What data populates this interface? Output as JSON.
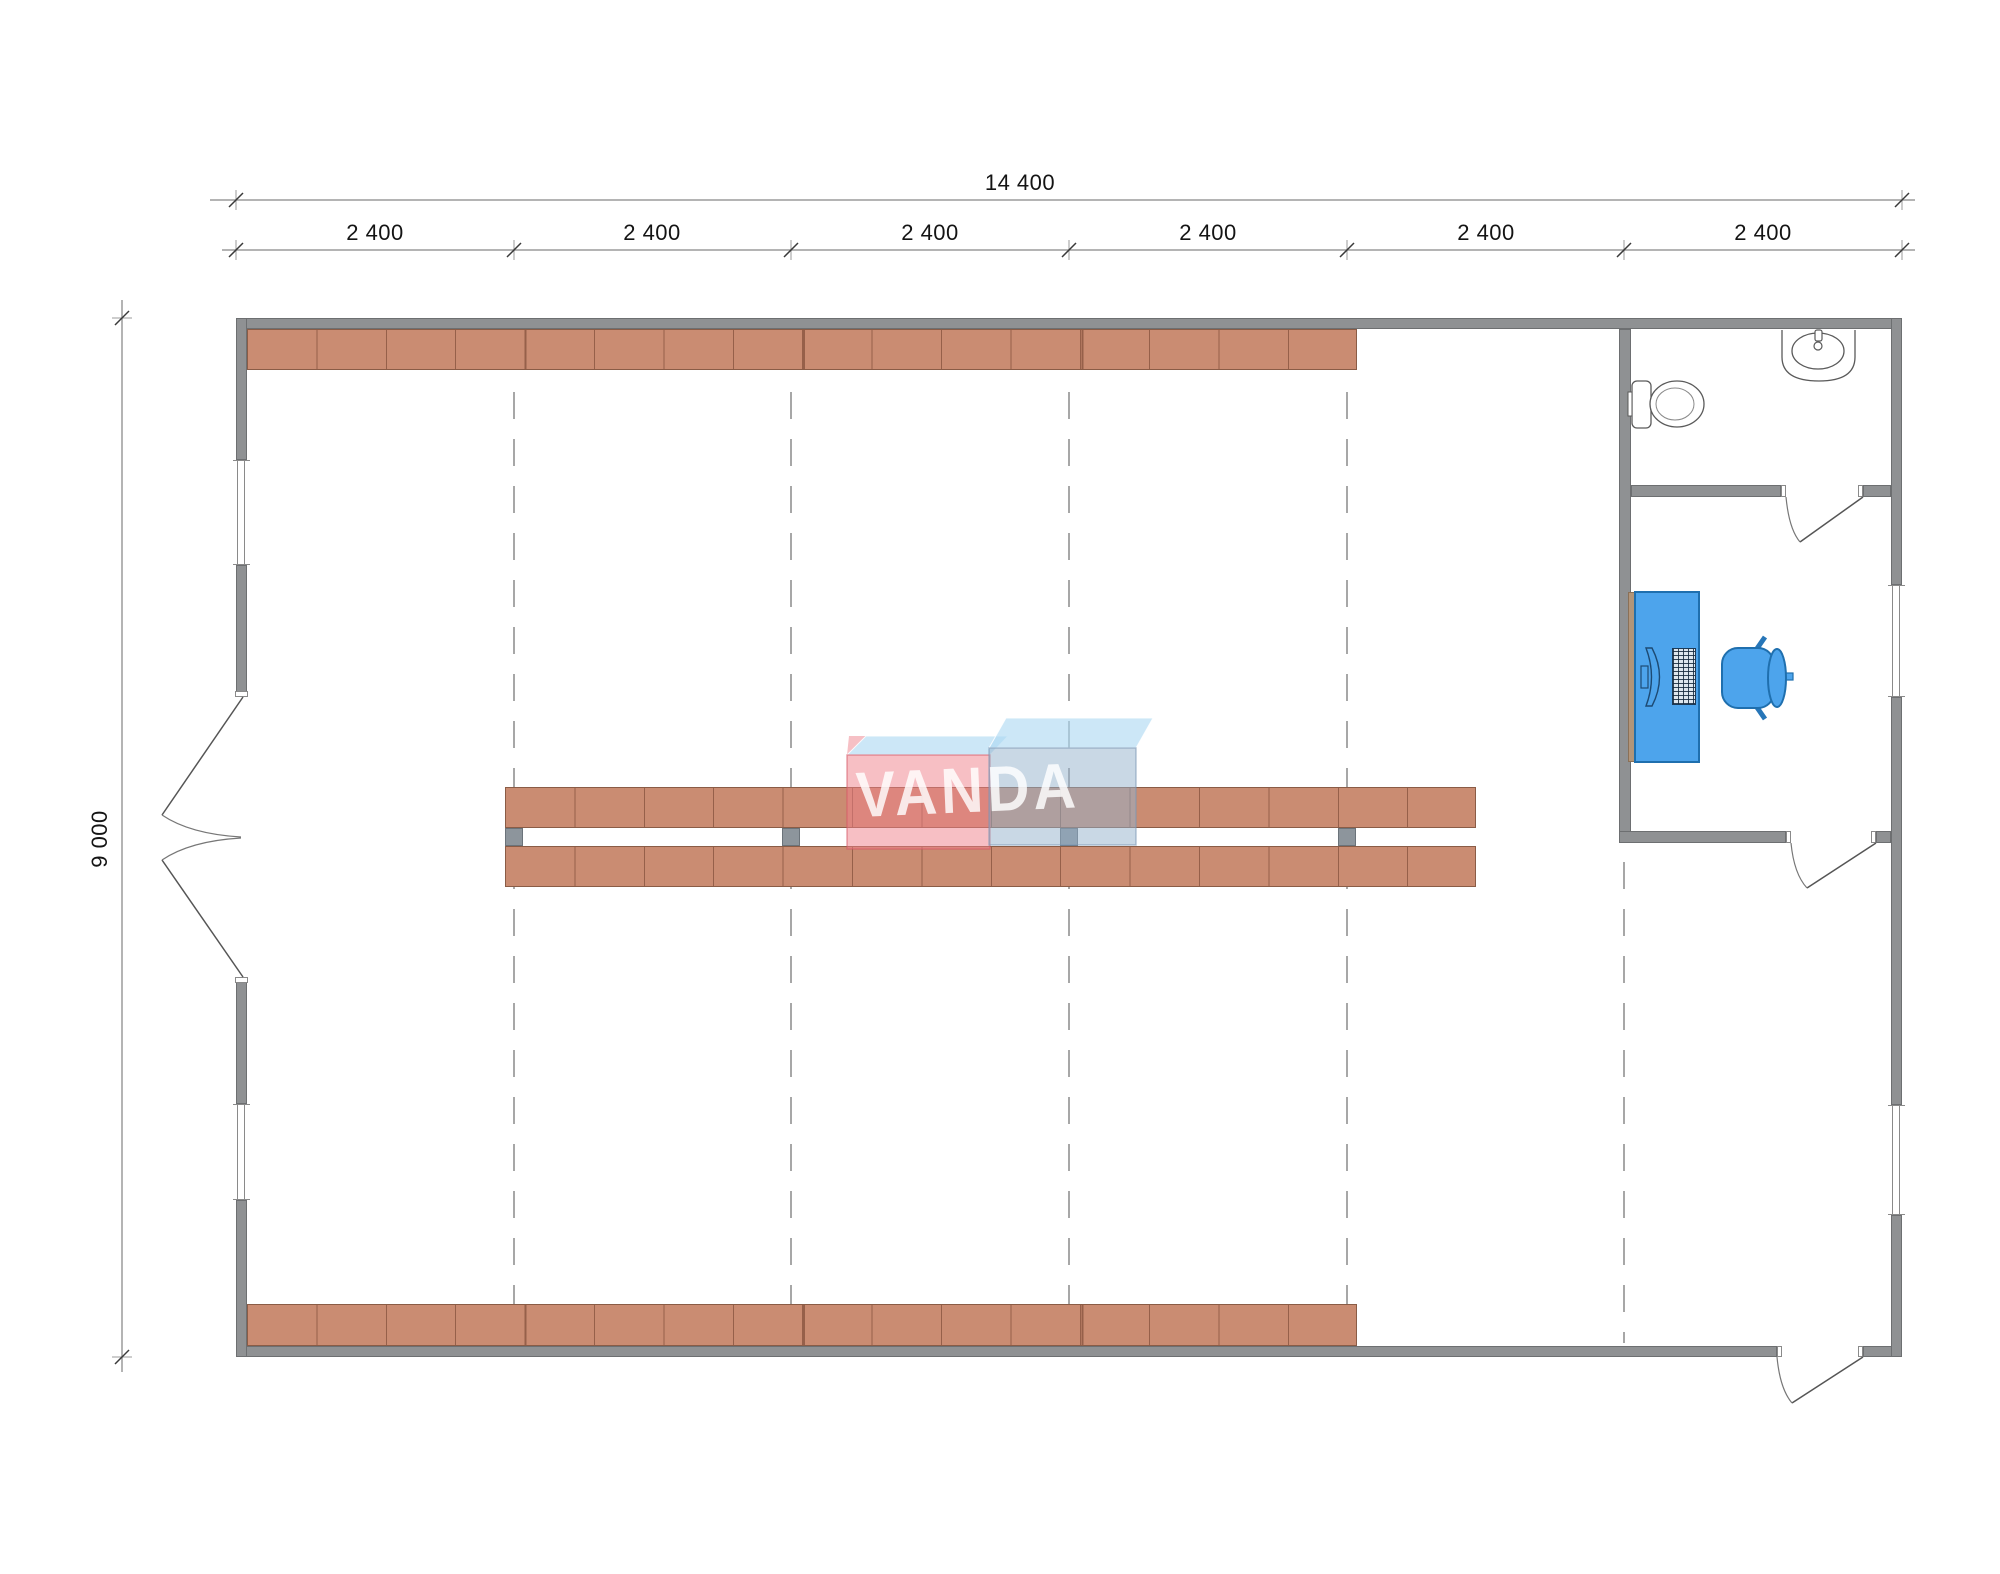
{
  "drawing": {
    "type": "architectural floor plan",
    "watermark": "VANDA"
  },
  "dims": {
    "total_width": "14 400",
    "bay_labels": [
      "2 400",
      "2 400",
      "2 400",
      "2 400",
      "2 400",
      "2 400"
    ],
    "total_height": "9 000"
  },
  "fixtures": {
    "toilet": "toilet-icon",
    "sink": "sink-icon",
    "desk": "desk-with-computer",
    "chair": "office-chair-icon",
    "shelving": "storage-shelf-rows",
    "doors": [
      "double-entry-door-left",
      "bathroom-door",
      "office-door",
      "exterior-door-bottom-right"
    ]
  },
  "colors": {
    "wall": "#8f9193",
    "shelf": "#ca8c72",
    "furniture_blue": "#4da4ec",
    "logo_pink": "#f0808a",
    "logo_blue_front": "#94b1cb",
    "logo_top": "#add9f2",
    "dashed_line": "#8a8a8a"
  }
}
